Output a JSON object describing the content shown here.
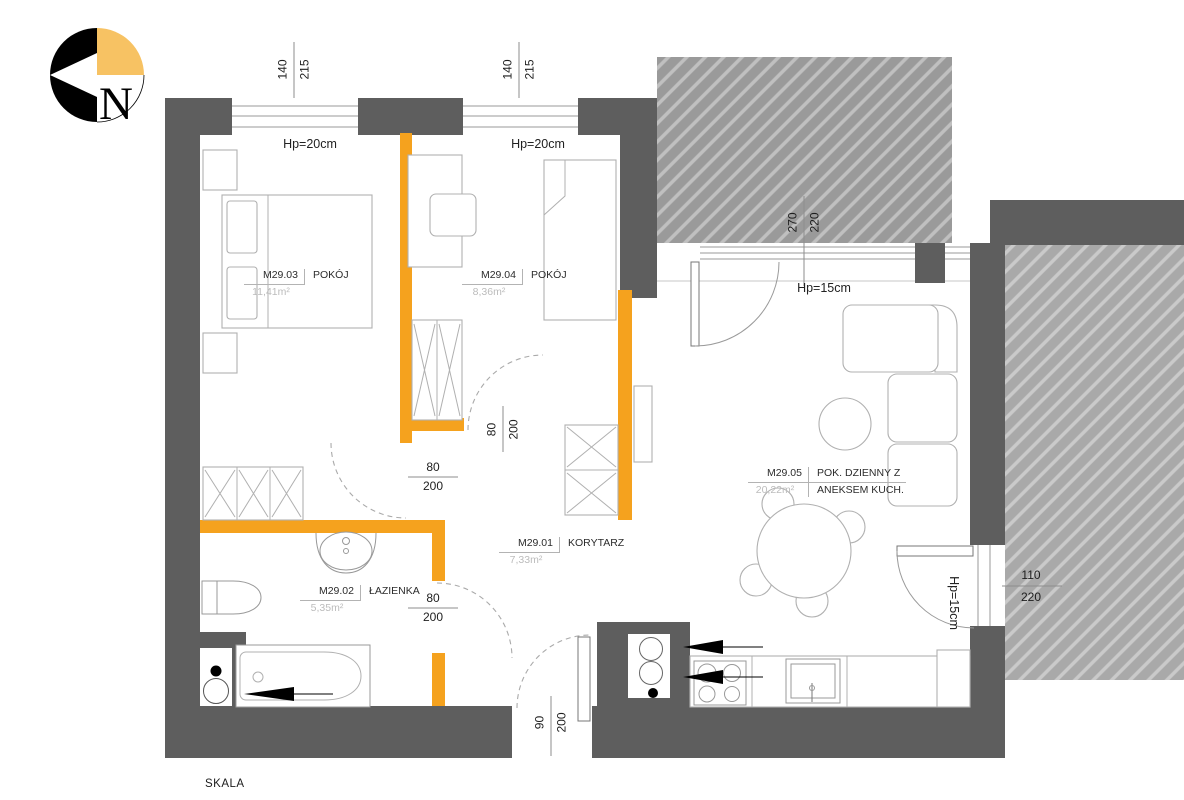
{
  "colors": {
    "wall_gray": "#5e5e5e",
    "orange": "#F5A21E",
    "balcony_gray": "#9a9a9a",
    "terrace_gray": "#a9a9a9",
    "furniture_line": "#b0b0b0",
    "dim_text": "#1e1e1e",
    "area_text": "#bcbcbc",
    "compass_orange": "#F7C263"
  },
  "compass": {
    "north_letter": "N"
  },
  "footer": {
    "scale_label": "SKALA"
  },
  "rooms": {
    "korytarz": {
      "id": "M29.01",
      "name": "KORYTARZ",
      "area": "7,33m²"
    },
    "lazienka": {
      "id": "M29.02",
      "name": "ŁAZIENKA",
      "area": "5,35m²"
    },
    "pokoj1": {
      "id": "M29.03",
      "name": "POKÓJ",
      "area": "11,41m²"
    },
    "pokoj2": {
      "id": "M29.04",
      "name": "POKÓJ",
      "area": "8,36m²"
    },
    "salon": {
      "id": "M29.05",
      "name_line1": "POK. DZIENNY Z",
      "name_line2": "ANEKSEM KUCH.",
      "area": "20,22m²"
    }
  },
  "hp": {
    "win1": "Hp=20cm",
    "win2": "Hp=20cm",
    "living_top": "Hp=15cm",
    "living_right": "Hp=15cm"
  },
  "dims": {
    "top_window_1": {
      "w": "140",
      "h": "215"
    },
    "top_window_2": {
      "w": "140",
      "h": "215"
    },
    "balcony_door_top": {
      "w": "270",
      "h": "220"
    },
    "balcony_door_right": {
      "w": "110",
      "h": "220"
    },
    "entry_door": {
      "w": "90",
      "h": "200"
    },
    "bedroom1_door": {
      "w": "80",
      "h": "200"
    },
    "bedroom2_door": {
      "w": "80",
      "h": "200"
    },
    "bathroom_door": {
      "w": "80",
      "h": "200"
    }
  }
}
